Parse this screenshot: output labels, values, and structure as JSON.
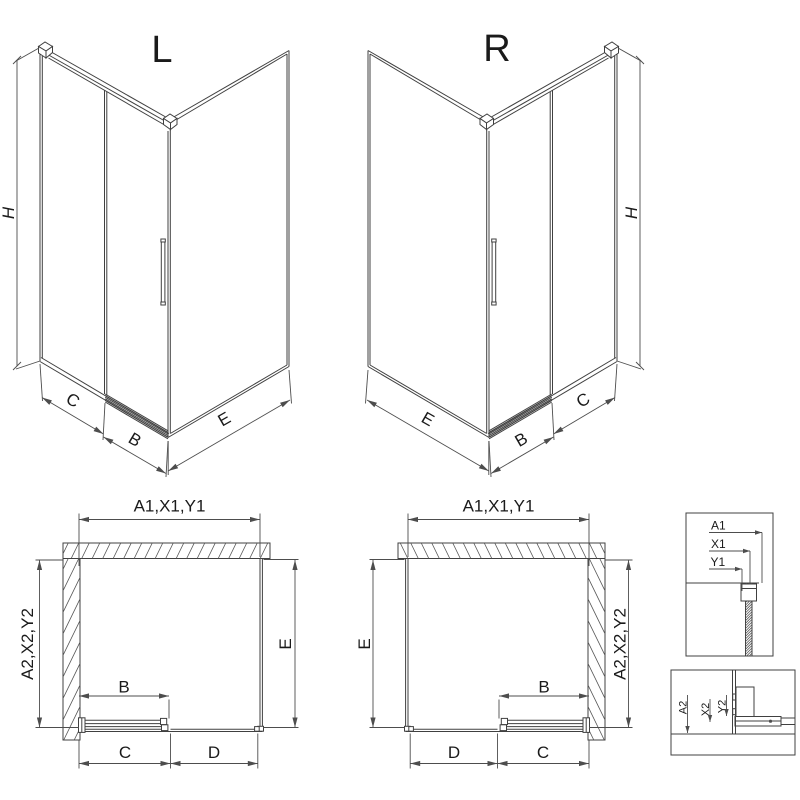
{
  "iso_left": {
    "variant": "L",
    "h": "H",
    "c": "C",
    "b": "B",
    "e": "E"
  },
  "iso_right": {
    "variant": "R",
    "h": "H",
    "c": "C",
    "b": "B",
    "e": "E"
  },
  "plan_left": {
    "top": "A1,X1,Y1",
    "side": "A2,X2,Y2",
    "e": "E",
    "b": "B",
    "c": "C",
    "d": "D"
  },
  "plan_right": {
    "top": "A1,X1,Y1",
    "side": "A2,X2,Y2",
    "e": "E",
    "b": "B",
    "c": "C",
    "d": "D"
  },
  "detail_top": {
    "a1": "A1",
    "x1": "X1",
    "y1": "Y1"
  },
  "detail_bottom": {
    "a2": "A2",
    "x2": "X2",
    "y2": "Y2"
  },
  "colors": {
    "line": "#404040",
    "dim": "#4d4d4d",
    "text": "#1a1a1a",
    "background": "#ffffff"
  }
}
